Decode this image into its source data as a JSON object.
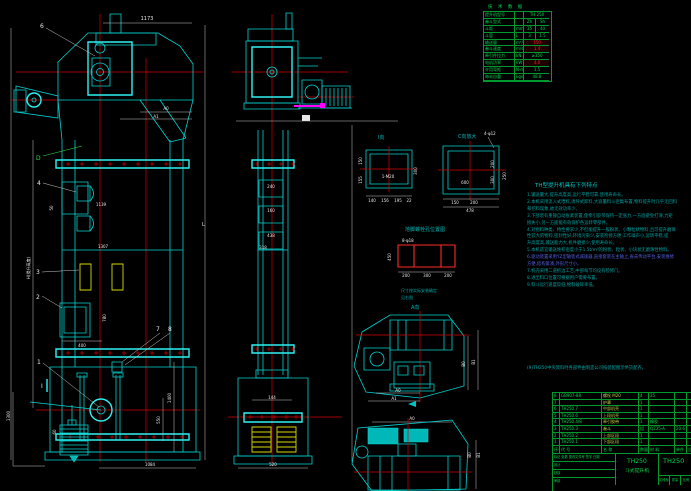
{
  "colors": {
    "background": "#000000",
    "line_cyan": "#00d4d4",
    "line_bright": "#2ef2f2",
    "centerline_red": "#d40000",
    "detail_red": "#ff2a2a",
    "table_green": "#00992e",
    "text_green": "#00d44c",
    "dim_white": "#e8e8e8",
    "bucket_yellow": "#d8d800",
    "accent_magenta": "#ff00ff",
    "note_teal": "#00a8a8",
    "note_blue": "#5560e0",
    "bom_name_yellow": "#c3ca40"
  },
  "tech_table": {
    "title": "技 术 数 据",
    "rows": [
      {
        "label": "提升机型号",
        "unit": "",
        "v1": "TH 250",
        "v2": ""
      },
      {
        "label": "畚斗型式",
        "unit": "",
        "v1": "Zh",
        "v2": "Sh"
      },
      {
        "label": "斗距",
        "unit": "mm",
        "v1": "35",
        "v2": "40"
      },
      {
        "label": "斗容",
        "unit": "L",
        "v1": "3",
        "v2": "1.5"
      },
      {
        "label": "输送量",
        "unit": "m³/h",
        "v1": "150",
        "v2": ""
      },
      {
        "label": "畚斗速度",
        "unit": "m/s",
        "v1": "1.4",
        "v2": ""
      },
      {
        "label": "牵引件拉力",
        "unit": "kN",
        "v1": "≥350",
        "v2": ""
      },
      {
        "label": "电机功率",
        "unit": "kW",
        "v1": "4.0",
        "v2": ""
      },
      {
        "label": "许用弯矩",
        "unit": "N·m",
        "v1": "1.5",
        "v2": ""
      },
      {
        "label": "每米自重",
        "unit": "kg/m",
        "v1": "48.8",
        "v2": ""
      }
    ]
  },
  "features": {
    "title": "TH型提升机具有下列特点",
    "lines": [
      "1.输送量大,提升高度高,运行平稳可靠,使用寿命长。",
      "2.本机采用流入式喂料,诱导式卸料,大容量料斗密集布置,物料提升时几乎无回料",
      "和挖料现象,故无效功率少。",
      "3.下部装有重锤自动张紧装置,使牵引胶带保持一定张力,一方面避免打滑,力矩",
      "损失小,另一方面能有效保护各运转零部件。",
      "4.对物料种类、特性要求少,不但能提升一般粉状、小颗粒状物料,且可提升磨琢",
      "性较大的物料,密封性好,环境污染少,安装检修方便,工作噪声小,运转平稳,提",
      "升高度高,输送能力大,机件磨损少,使用寿命长。",
      "5.本机适宜输送堆积密度小于1.5t/m³的粉状、粒状、小块状无磨琢性物料。",
      "6.驱动装置采用YZ型轴装式减速器,直接套装在主轴上,省去传动平台,安装维修",
      "方便,结构紧凑,外形尺寸小。",
      "7.机壳采用二道折边工艺,中部每节均设有检修门。",
      "8.进出料口位置可根据用户需要布置。",
      "9.料斗运行速度较低,物料破碎率低。"
    ]
  },
  "footnote": "(9)TH250中央装料时各部件由制造公司按装配图示供货配齐。",
  "bom": {
    "header": [
      "序号",
      "代 号",
      "名 称",
      "数量",
      "材 料",
      "单件",
      "总计"
    ],
    "rows": [
      [
        "8",
        "GB907-88",
        "螺栓 M20",
        "4",
        "35",
        "",
        ""
      ],
      [
        "7",
        "",
        "护罩",
        "1",
        "",
        "",
        ""
      ],
      [
        "6",
        "TH250.7",
        "中部机壳",
        "1",
        "",
        "",
        ""
      ],
      [
        "5",
        "TH250.6",
        "上段机壳",
        "1",
        "",
        "",
        ""
      ],
      [
        "4",
        "TH250.4/8",
        "牵引胶带",
        "1",
        "橡胶",
        "",
        ""
      ],
      [
        "3",
        "TH250.3",
        "畚斗",
        "组",
        "Q235-A",
        "20.6",
        ""
      ],
      [
        "2",
        "TH250.2",
        "上部区段",
        "1",
        "",
        "",
        ""
      ],
      [
        "1",
        "TH250.1",
        "下部区段",
        "1",
        "",
        "",
        ""
      ]
    ]
  },
  "title_block": {
    "model": "TH250",
    "product": "斗式提升机",
    "dwg_no": "TH250",
    "sig_row": "标记 处数 更改文件号 签字 日期",
    "row_design": "设计",
    "row_check": "校核",
    "row_approve": "审核",
    "stage": "阶段标记",
    "mass": "质量",
    "scale": "比例"
  },
  "labels": {
    "d1173": "1173",
    "a0": "A0",
    "a1": "A1",
    "L": "L",
    "h_rot": "H(提升高度)",
    "d1139": "1139",
    "d1307": "1307",
    "d50": "50",
    "d400": "400",
    "d780": "780",
    "d1400": "1400",
    "d550": "550",
    "d1084": "1084",
    "d1300": "1300",
    "d60": "60",
    "m240": "240",
    "m160": "160",
    "m438": "438",
    "m318": "318",
    "m144": "144",
    "m520": "520",
    "view_i": "I向",
    "i_bolt": "1-M20",
    "i150": "150",
    "i155": "155",
    "i300": "300",
    "i140": "140",
    "i156": "156",
    "i195": "195",
    "i22": "22",
    "view_c": "C向放大",
    "c_bolt": "4-φ12",
    "c600": "600",
    "c200": "200",
    "c300": "300",
    "c250": "250",
    "c150": "150",
    "c200b": "200",
    "c478": "478",
    "caption_holes": "地脚螺栓孔位置图",
    "g_bolt": "8-φ18",
    "g450": "450",
    "g200a": "200",
    "g300": "300",
    "g200b": "200",
    "note1": "尺寸按实际安装确定",
    "note2": "见右图",
    "view_a": "A向",
    "a0a": "A0",
    "a1a": "A1",
    "b0a": "B0",
    "b1a": "B1",
    "a0b": "A0",
    "b0b": "B0",
    "b1b": "B1",
    "sec_i": "I"
  },
  "balloons": {
    "b1": "1",
    "b2": "2",
    "b3": "3",
    "b4": "4",
    "b6": "6",
    "b7": "7",
    "b8": "8",
    "bd": "D"
  }
}
